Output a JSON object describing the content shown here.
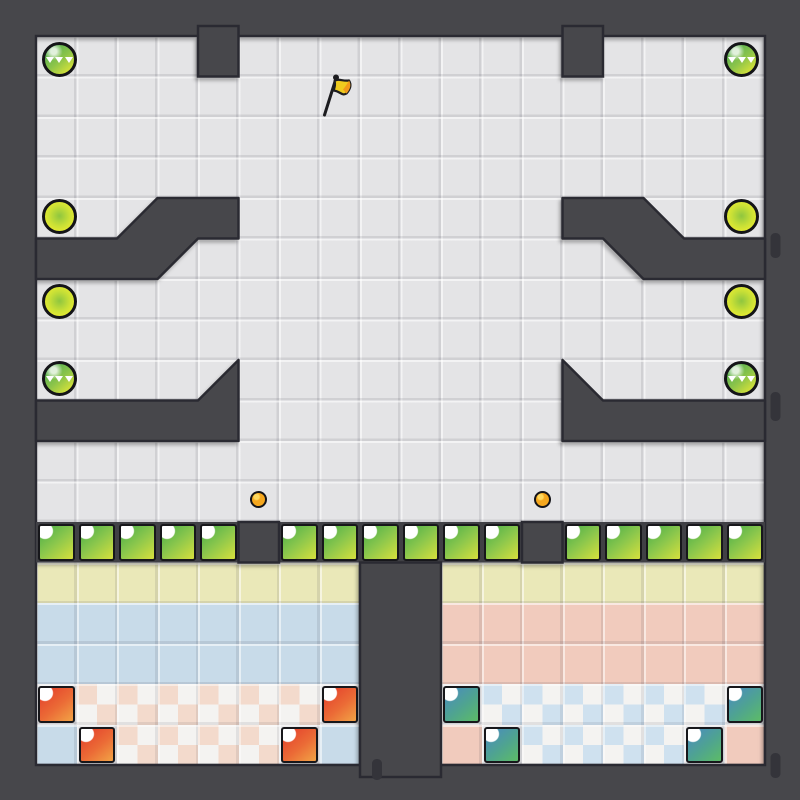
{
  "scene": {
    "kind": "puzzle-game-level",
    "grid": {
      "origin": 36,
      "pitch": 40.5,
      "cols": 18,
      "rows": 18,
      "canvas": 800
    }
  },
  "colors": {
    "border": "#47474c",
    "wallEdge": "#2c2c31",
    "slot": "#34343a",
    "floor": "#e4e4e6",
    "yellowTile": "#eae8b8",
    "blueTile": "#c8dbe9",
    "pinkTile": "#f1cbbd",
    "checkerPink": "#f3dacc",
    "checkerBlue": "#cfe1ef",
    "checkerWhite": "#f4f3f1",
    "greenRowBg": "#3f3f45",
    "blockBorder": "#17171b",
    "greenBlock0": "#4fb04a",
    "greenBlock1": "#8cc74c",
    "greenBlock2": "#cfdd3e",
    "redBlock0": "#e4402c",
    "redBlock1": "#eb6b36",
    "redBlock2": "#f19d44",
    "tealBlock0": "#4a8cbf",
    "tealBlock1": "#4fa48f",
    "tealBlock2": "#5bb96b",
    "dotGreen0": "#55b052",
    "dotGreen1": "#8cc44a",
    "dotGreen2": "#d9e338",
    "dotYellow0": "#8fc63f",
    "dotYellow1": "#c9e036",
    "dotYellow2": "#e8eb31",
    "dotOrange": "#f5a71e",
    "dotOrangeHi": "#ffd95e",
    "flagYellow": "#eecb1e",
    "flagOrange": "#f09a1a",
    "flagDark": "#1d1d20"
  },
  "cells": [
    "....#........#....",
    "..................",
    "..................",
    "..................",
    "..a##........##b..",
    "###c..........d###",
    "..................",
    "..................",
    "....a........b....",
    "#####........#####",
    "..................",
    "..................",
    "GGGGGDGGGGGGDGGGGG",
    "YYYYYYYY##YYYYYYYY",
    "BBBBBBBB##PPPPPPPP",
    "BBBBBBBB##PPPPPPPP",
    "RppppppR##TqqqqqqT",
    "BRppppRB##PTqqqqTP"
  ],
  "walls": {
    "strip": {
      "gx": 0,
      "gy": 12,
      "w": 18,
      "h": 1
    },
    "rects": [
      {
        "gx": 4,
        "gy": 0,
        "w": 1,
        "h": 1,
        "up": 10
      },
      {
        "gx": 13,
        "gy": 0,
        "w": 1,
        "h": 1,
        "up": 10
      },
      {
        "gx": 5,
        "gy": 12,
        "w": 1,
        "h": 1
      },
      {
        "gx": 12,
        "gy": 12,
        "w": 1,
        "h": 1
      },
      {
        "gx": 8,
        "gy": 13,
        "w": 2,
        "h": 5,
        "down": 12
      }
    ],
    "polys": [
      [
        [
          3,
          4
        ],
        [
          5,
          4
        ],
        [
          5,
          5
        ],
        [
          4,
          5
        ],
        [
          3,
          6
        ],
        [
          0,
          6
        ],
        [
          0,
          5
        ],
        [
          2,
          5
        ]
      ],
      [
        [
          15,
          4
        ],
        [
          13,
          4
        ],
        [
          13,
          5
        ],
        [
          14,
          5
        ],
        [
          15,
          6
        ],
        [
          18,
          6
        ],
        [
          18,
          5
        ],
        [
          16,
          5
        ]
      ],
      [
        [
          5,
          8
        ],
        [
          5,
          10
        ],
        [
          0,
          10
        ],
        [
          0,
          9
        ],
        [
          4,
          9
        ]
      ],
      [
        [
          13,
          8
        ],
        [
          13,
          10
        ],
        [
          18,
          10
        ],
        [
          18,
          9
        ],
        [
          14,
          9
        ]
      ]
    ],
    "slots": [
      {
        "x": 770.5,
        "y": 233,
        "w": 10,
        "h": 25
      },
      {
        "x": 770.5,
        "y": 392,
        "w": 10,
        "h": 29
      },
      {
        "x": 770.5,
        "y": 753,
        "w": 10,
        "h": 25
      },
      {
        "x": 372,
        "y": 759,
        "w": 10,
        "h": 21
      }
    ]
  },
  "dots": [
    {
      "kind": "green",
      "col": 0,
      "row": 0,
      "dx": 3,
      "dy": 3
    },
    {
      "kind": "green",
      "col": 17,
      "row": 0,
      "dx": -3,
      "dy": 3
    },
    {
      "kind": "yellow",
      "col": 0,
      "row": 4,
      "dx": 3,
      "dy": -2
    },
    {
      "kind": "yellow",
      "col": 17,
      "row": 4,
      "dx": -3,
      "dy": -2
    },
    {
      "kind": "yellow",
      "col": 0,
      "row": 6,
      "dx": 3,
      "dy": 2
    },
    {
      "kind": "yellow",
      "col": 17,
      "row": 6,
      "dx": -3,
      "dy": 2
    },
    {
      "kind": "green",
      "col": 0,
      "row": 8,
      "dx": 3,
      "dy": -2
    },
    {
      "kind": "green",
      "col": 17,
      "row": 8,
      "dx": -3,
      "dy": -2
    },
    {
      "kind": "orange",
      "col": 5,
      "row": 11,
      "dx": 0,
      "dy": -2
    },
    {
      "kind": "orange",
      "col": 12,
      "row": 11,
      "dx": 0,
      "dy": -2
    }
  ],
  "flag": {
    "x": 312,
    "y": 70,
    "size": 48
  }
}
